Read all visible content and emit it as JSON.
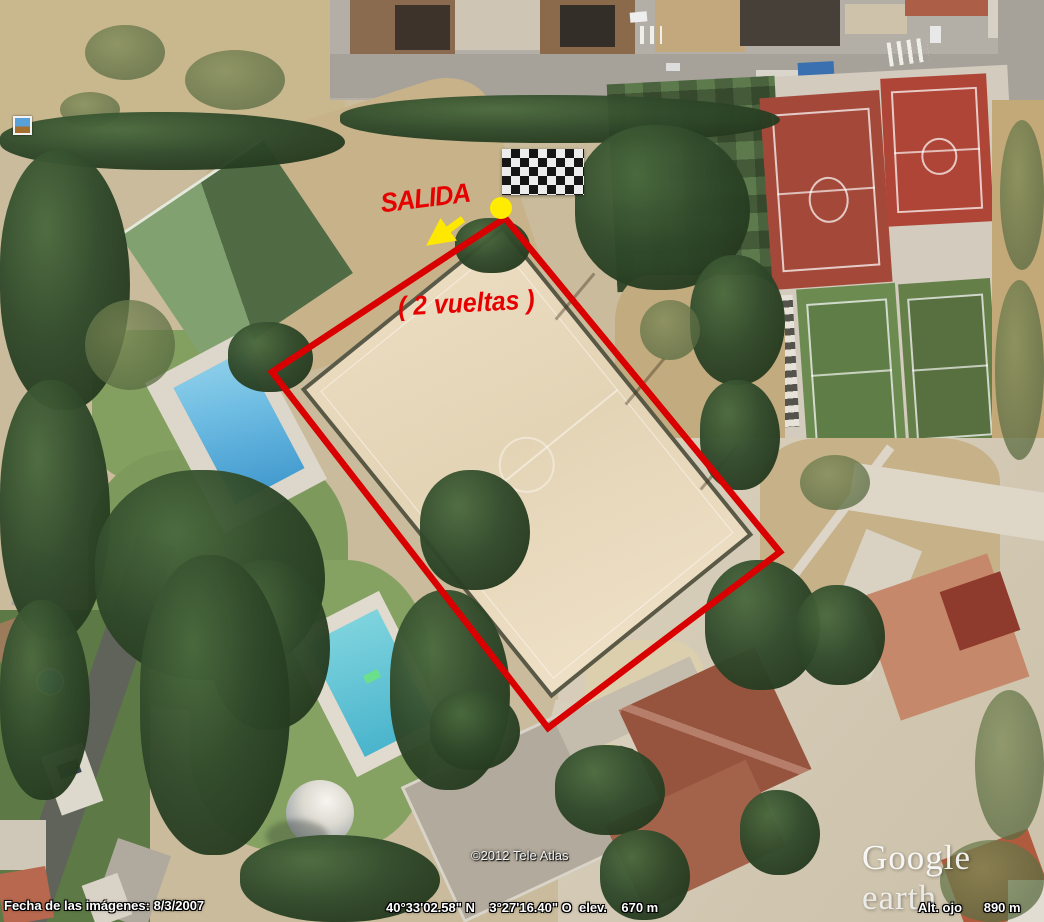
{
  "app": {
    "name": "Google Earth",
    "watermark_primary": "Google",
    "watermark_secondary": " earth"
  },
  "annotations": {
    "start_label": "SALIDA",
    "laps_label": "( 2 vueltas )",
    "route_color": "#d80000",
    "start_point_color": "#ffec00",
    "arrow_color": "#ffe800",
    "finish_flag_icon": "checkered-flag",
    "start_photo_icon": "photo-marker"
  },
  "attribution": {
    "copyright": "©2012 Tele Atlas"
  },
  "status_bar": {
    "imagery_date": "Fecha de las imágenes: 8/3/2007",
    "coordinates": "40°33'02.58\" N    3°27'16.40\" O  elev.    670 m",
    "eye_altitude": "Alt. ojo      890 m"
  }
}
